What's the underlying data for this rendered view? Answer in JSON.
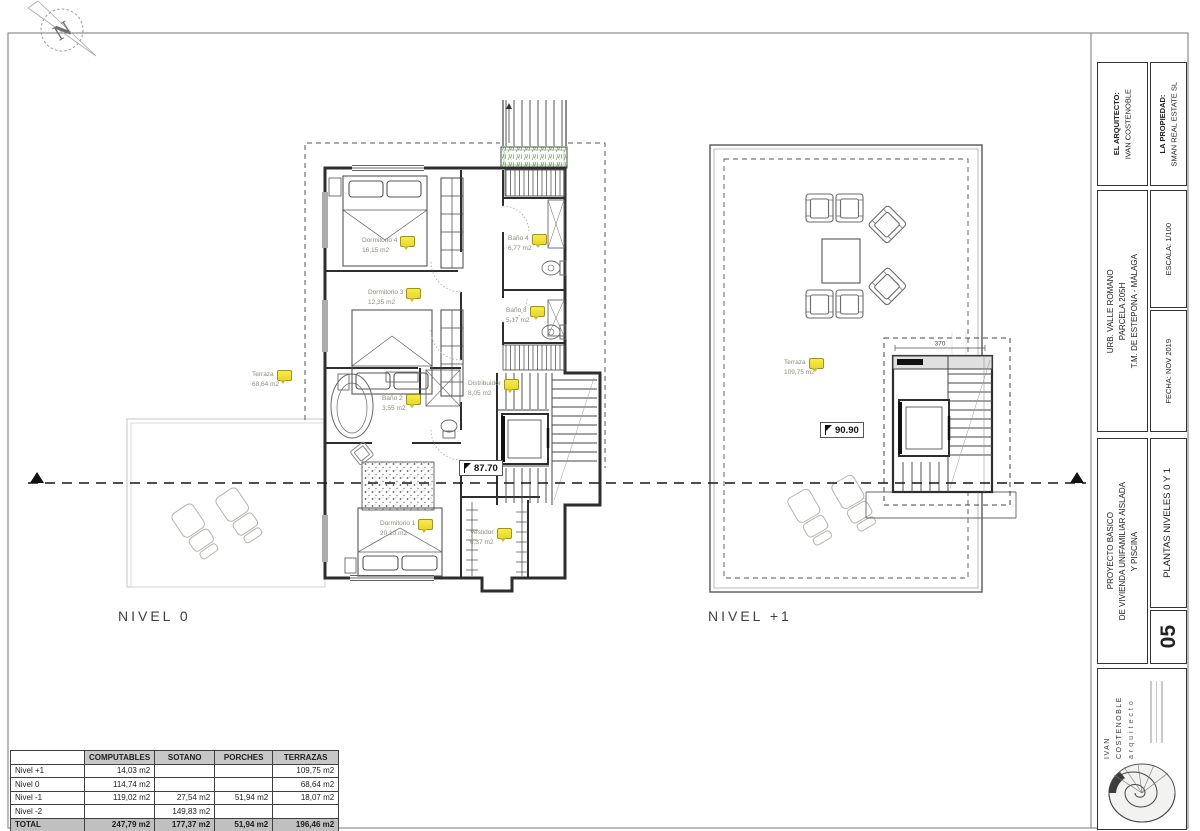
{
  "sheet": {
    "north_letter": "N"
  },
  "plans": {
    "nivel0": {
      "label": "NIVEL 0",
      "level_marker": "87.70",
      "rooms": {
        "dormitorio4": {
          "name": "Dormitorio 4",
          "area": "16,15 m2"
        },
        "dormitorio3": {
          "name": "Dormitorio 3",
          "area": "12,35 m2"
        },
        "bano4": {
          "name": "Baño 4",
          "area": "6,77 m2"
        },
        "bano3": {
          "name": "Baño 3",
          "area": "5,17 m2"
        },
        "bano2": {
          "name": "Baño 2",
          "area": "3,55 m2"
        },
        "distribuidor": {
          "name": "Distribuidor",
          "area": "8,05 m2"
        },
        "dormitorio1": {
          "name": "Dormitorio 1",
          "area": "20,10 m2"
        },
        "vestidor": {
          "name": "Vestidor",
          "area": "6,37 m2"
        },
        "terraza": {
          "name": "Terraza",
          "area": "68,64 m2"
        }
      }
    },
    "nivel1": {
      "label": "NIVEL +1",
      "level_marker": "90.90",
      "stair_dimension": "370",
      "rooms": {
        "terraza": {
          "name": "Terraza",
          "area": "109,75 m2"
        }
      }
    }
  },
  "areas_table": {
    "columns": [
      "",
      "COMPUTABLES",
      "SOTANO",
      "PORCHES",
      "TERRAZAS"
    ],
    "rows": [
      {
        "label": "Nivel +1",
        "computables": "14,03 m2",
        "sotano": "",
        "porches": "",
        "terrazas": "109,75 m2"
      },
      {
        "label": "Nivel 0",
        "computables": "114,74 m2",
        "sotano": "",
        "porches": "",
        "terrazas": "68,64 m2"
      },
      {
        "label": "Nivel -1",
        "computables": "119,02 m2",
        "sotano": "27,54 m2",
        "porches": "51,94 m2",
        "terrazas": "18,07 m2"
      },
      {
        "label": "Nivel -2",
        "computables": "",
        "sotano": "149,83 m2",
        "porches": "",
        "terrazas": ""
      },
      {
        "label": "TOTAL",
        "computables": "247,79 m2",
        "sotano": "177,37 m2",
        "porches": "51,94 m2",
        "terrazas": "196,46 m2"
      }
    ]
  },
  "title_block": {
    "architect_label": "EL ARQUITECTO:",
    "architect_name": "IVAN COSTENOBLE",
    "owner_label": "LA PROPIEDAD:",
    "owner_name": "SMAN REAL ESTATE SL",
    "location_line1": "URB. VALLE ROMANO",
    "location_line2": "PARCELA 205H",
    "location_line3": "T.M. DE ESTEPONA - MÁLAGA",
    "scale": "ESCALA: 1/100",
    "date": "FECHA: NOV 2019",
    "project_line1": "PROYECTO BÁSICO",
    "project_line2": "DE VIVIENDA UNIFAMILIAR AISLADA",
    "project_line3": "Y PISCINA",
    "sheet_number": "05",
    "sheet_title": "PLANTAS NIVELES 0 Y 1",
    "logo_name": "IVAN COSTENOBLE",
    "logo_subtitle": "arquitecto"
  },
  "colors": {
    "tag_yellow": "#f2e33b",
    "planter_green": "#6d9b5c",
    "line_dark": "#2e2e2e",
    "table_header_gray": "#c7c7c7"
  }
}
